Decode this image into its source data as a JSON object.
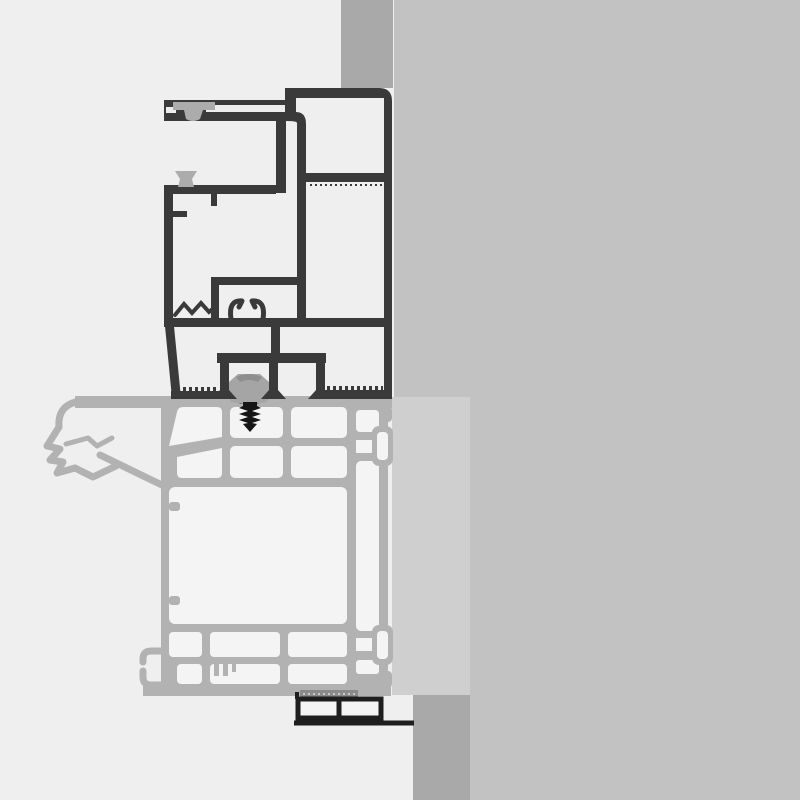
{
  "drawing": {
    "kind": "technical-cross-section",
    "subject": "window-frame-profile-installation-detail"
  },
  "colors": {
    "background": "#efefef",
    "wall": "#c2c2c2",
    "wall_edge": "#a9a9a9",
    "mounting_panel": "#cfcfcf",
    "frame_dark": "#3a3a3a",
    "frame_gray": "#b2b2b2",
    "chamber_fill": "#f4f4f4",
    "slit": "#ededed",
    "gasket": "#acacac",
    "roller": "#a5a5a5",
    "roller_shade": "#8e8e8e",
    "screw": "#151515",
    "trim_dark": "#1e1e1e",
    "hatch": "#8a8a8a",
    "hatch_tick": "#c9c9c9"
  }
}
